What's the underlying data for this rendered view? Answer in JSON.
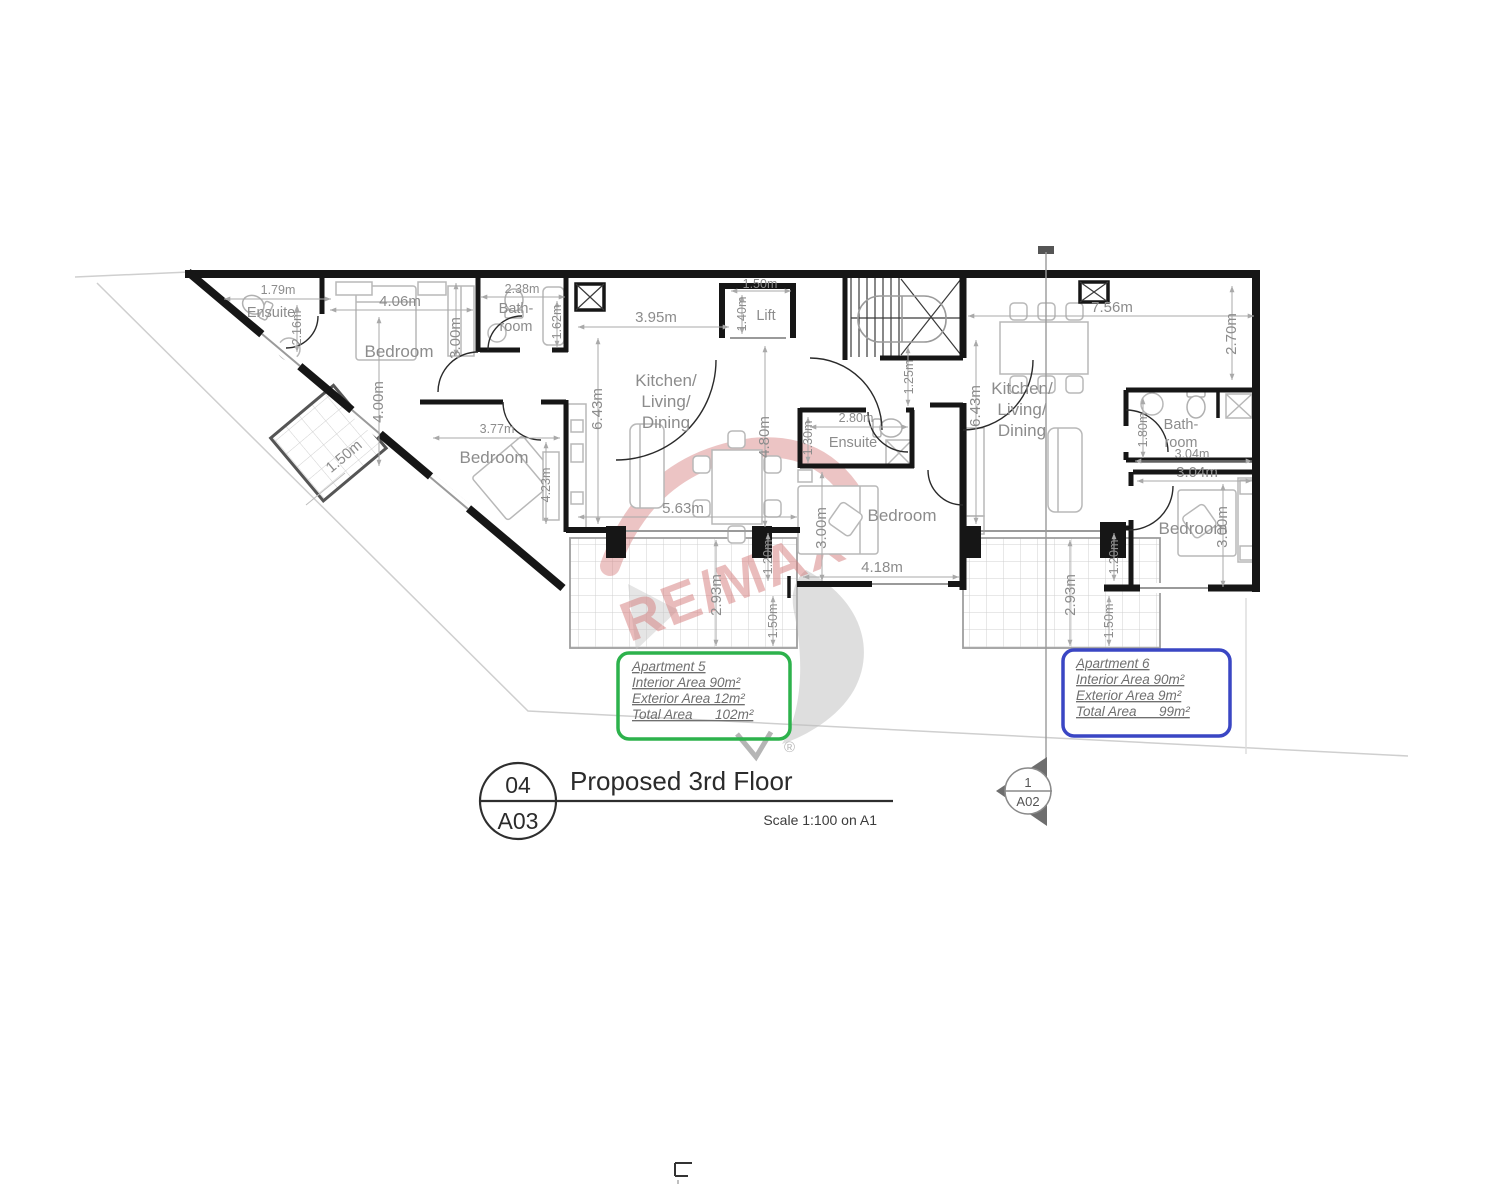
{
  "watermark": {
    "brand": "RE/MAX",
    "registered": "®",
    "color": "#d47c7c"
  },
  "title_block": {
    "detail_number": "04",
    "sheet_ref": "A03",
    "title": "Proposed 3rd Floor",
    "scale_note": "Scale 1:100 on A1"
  },
  "section_marker": {
    "number": "1",
    "sheet_ref": "A02"
  },
  "info_boxes": {
    "apartment5": {
      "accent": "#2db24c",
      "name": "Apartment 5",
      "interior_area": "Interior Area 90m²",
      "exterior_area": "Exterior Area 12m²",
      "total_area": "Total Area      102m²"
    },
    "apartment6": {
      "accent": "#3a46c4",
      "name": "Apartment 6",
      "interior_area": "Interior Area 90m²",
      "exterior_area": "Exterior Area 9m²",
      "total_area": "Total Area      99m²"
    }
  },
  "rooms": {
    "ensuite1": "Ensuite",
    "bedroom1": "Bedroom",
    "bathroom1_line1": "Bath-",
    "bathroom1_line2": "room",
    "kitchen1_line1": "Kitchen/",
    "kitchen1_line2": "Living/",
    "kitchen1_line3": "Dining",
    "bedroom2": "Bedroom",
    "lift": "Lift",
    "ensuite2": "Ensuite",
    "bedroom3": "Bedroom",
    "kitchen2_line1": "Kitchen/",
    "kitchen2_line2": "Living/",
    "kitchen2_line3": "Dining",
    "bathroom2_line1": "Bath-",
    "bathroom2_line2": "room",
    "bedroom4": "Bedroom"
  },
  "dimensions": {
    "ensuite1_width": "1.79m",
    "ensuite1_height": "2.16m",
    "bedroom1_width": "4.06m",
    "bedroom1_depth": "3.00m",
    "bedroom1_length": "4.00m",
    "bathroom1_width": "2.38m",
    "bathroom1_depth": "1.62m",
    "balcony_width": "1.50m",
    "bedroom2_width": "3.77m",
    "bedroom2_depth": "4.23m",
    "kitchen1_depth": "6.43m",
    "kitchen1_width": "3.95m",
    "kitchen1_inner": "4.80m",
    "kitchen1_length": "5.63m",
    "lift_width": "1.50m",
    "lift_depth": "1.40m",
    "landing_width": "1.25m",
    "ensuite2_width": "2.80m",
    "ensuite2_depth": "1.30m",
    "bedroom3_depth": "3.00m",
    "bedroom3_width": "4.18m",
    "terrace1_recess": "1.20m",
    "terrace1_depth": "2.93m",
    "terrace1_edge": "1.50m",
    "kitchen2_depth": "6.43m",
    "kitchen2_width": "7.56m",
    "kitchen2_recess": "2.70m",
    "bathroom2_depth": "1.80m",
    "bathroom2_width": "3.04m",
    "bedroom4_width": "3.04m",
    "bedroom4_depth": "3.00m",
    "terrace2_depth": "2.93m",
    "terrace2_recess": "1.20m",
    "terrace2_edge": "1.50m"
  }
}
